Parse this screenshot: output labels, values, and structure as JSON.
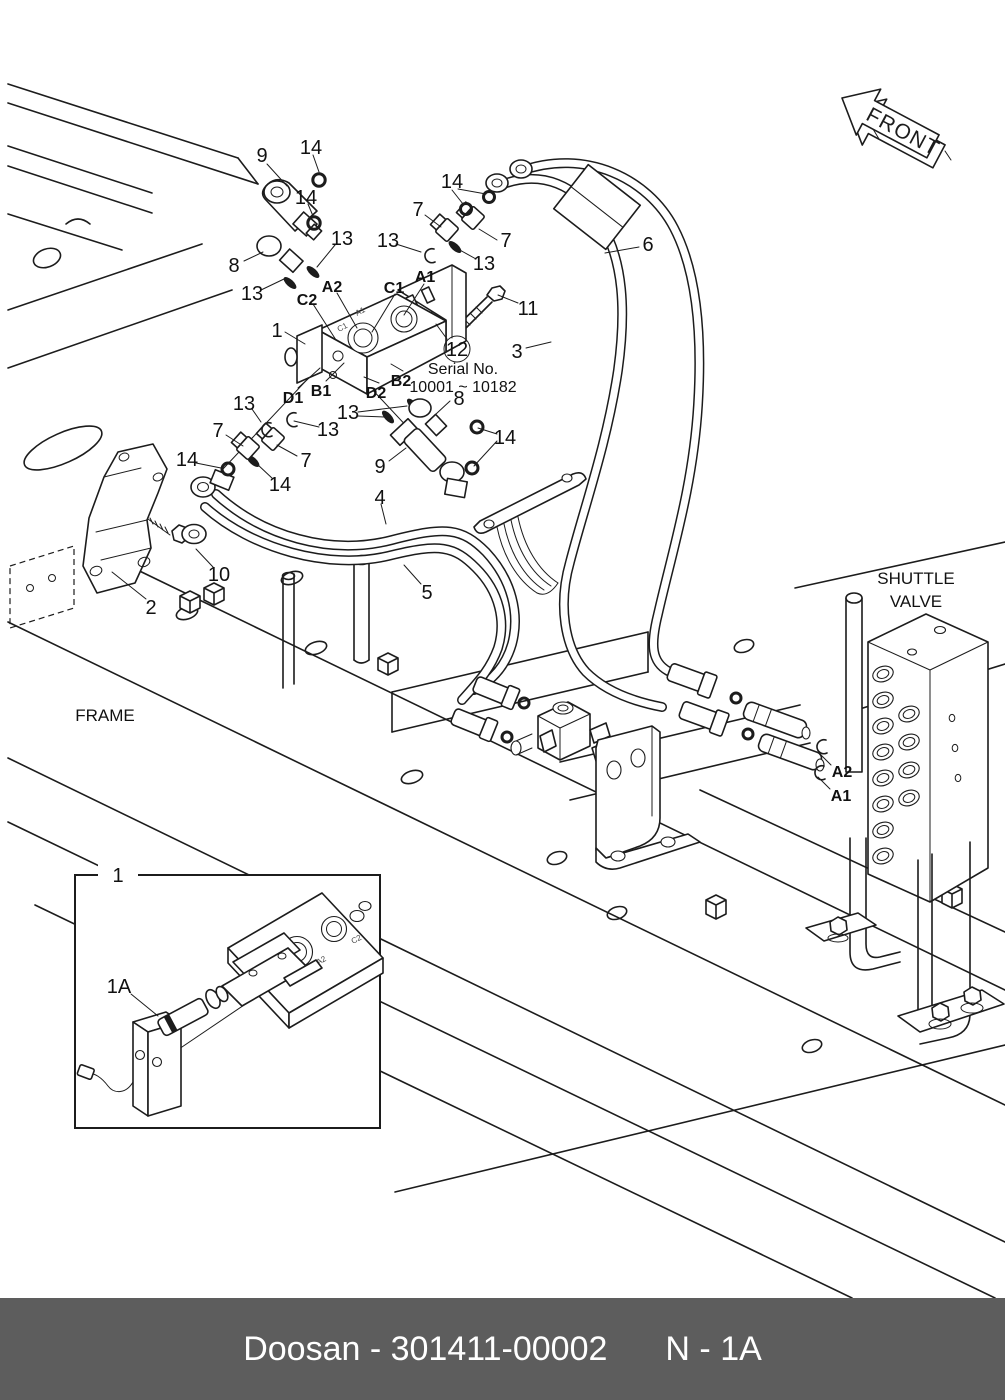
{
  "page": {
    "bg": "#ffffff",
    "ink": "#1c1c1c"
  },
  "front_arrow": {
    "label": "FRONT"
  },
  "labels": {
    "frame": "FRAME",
    "shuttle_line1": "SHUTTLE",
    "shuttle_line2": "VALVE",
    "serial_callout": "12",
    "serial_title": "Serial No.",
    "serial_range": "10001 ~ 10182"
  },
  "ports": {
    "c2": "C2",
    "a2": "A2",
    "c1": "C1",
    "a1": "A1",
    "b1": "B1",
    "d1": "D1",
    "d2": "D2",
    "b2": "B2",
    "shuttle_a2": "A2",
    "shuttle_a1": "A1"
  },
  "engravings": {
    "valve_a1": "A1",
    "valve_c1": "C1",
    "inset_a2": "A2",
    "inset_c2": "C2"
  },
  "callouts": {
    "n1_main": "1",
    "n1_inset": "1",
    "n1a_inset": "1A",
    "n2": "2",
    "n3": "3",
    "n4": "4",
    "n5": "5",
    "n6": "6",
    "n7_top_left": "7",
    "n7_top_right": "7",
    "n7_mid_left": "7",
    "n7_mid_right": "7",
    "n8_top": "8",
    "n8_mid": "8",
    "n9_top": "9",
    "n9_mid": "9",
    "n10": "10",
    "n11": "11",
    "n13_a": "13",
    "n13_b": "13",
    "n13_c": "13",
    "n13_d": "13",
    "n13_e": "13",
    "n13_f": "13",
    "n13_g": "13",
    "n14_a": "14",
    "n14_b": "14",
    "n14_c": "14",
    "n14_d": "14",
    "n14_e": "14",
    "n14_f": "14"
  },
  "footer": {
    "left": "Doosan - 301411-00002",
    "right": "N - 1A",
    "bar_color": "#5d5d5d"
  }
}
